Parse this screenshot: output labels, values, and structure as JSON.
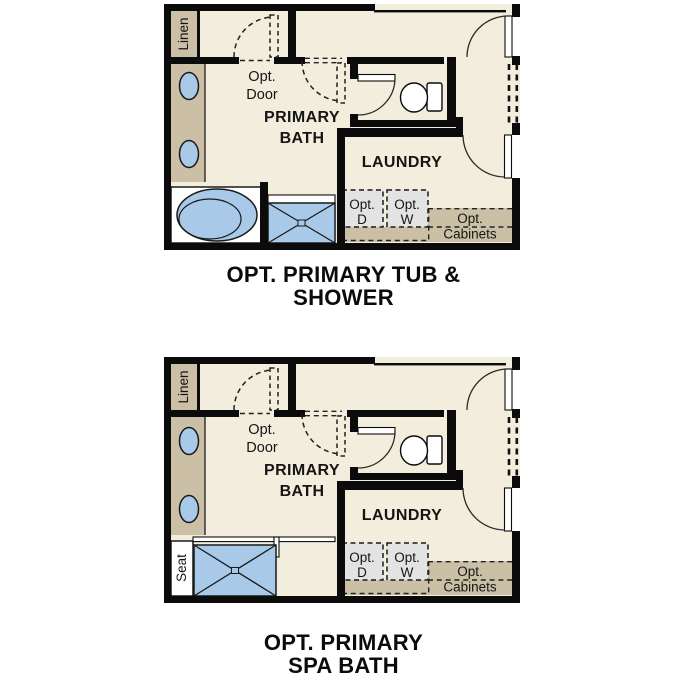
{
  "colors": {
    "floor": "#f3edde",
    "cabinet_tan": "#cbbfa5",
    "fixture_blue": "#a9c9e9",
    "appliance_gray": "#e3e3e3",
    "wall_black": "#0b0b0b",
    "text": "#151515"
  },
  "plans": [
    {
      "title_line1": "OPT. PRIMARY TUB &",
      "title_line2": "SHOWER",
      "labels": {
        "linen": "Linen",
        "opt_door_line1": "Opt.",
        "opt_door_line2": "Door",
        "room_line1": "PRIMARY",
        "room_line2": "BATH",
        "laundry": "LAUNDRY",
        "dryer_line1": "Opt.",
        "dryer_line2": "D",
        "washer_line1": "Opt.",
        "washer_line2": "W",
        "cabinets_line1": "Opt.",
        "cabinets_line2": "Cabinets"
      }
    },
    {
      "title_line1": "OPT. PRIMARY",
      "title_line2": "SPA BATH",
      "labels": {
        "linen": "Linen",
        "opt_door_line1": "Opt.",
        "opt_door_line2": "Door",
        "room_line1": "PRIMARY",
        "room_line2": "BATH",
        "laundry": "LAUNDRY",
        "seat": "Seat",
        "dryer_line1": "Opt.",
        "dryer_line2": "D",
        "washer_line1": "Opt.",
        "washer_line2": "W",
        "cabinets_line1": "Opt.",
        "cabinets_line2": "Cabinets"
      }
    }
  ]
}
